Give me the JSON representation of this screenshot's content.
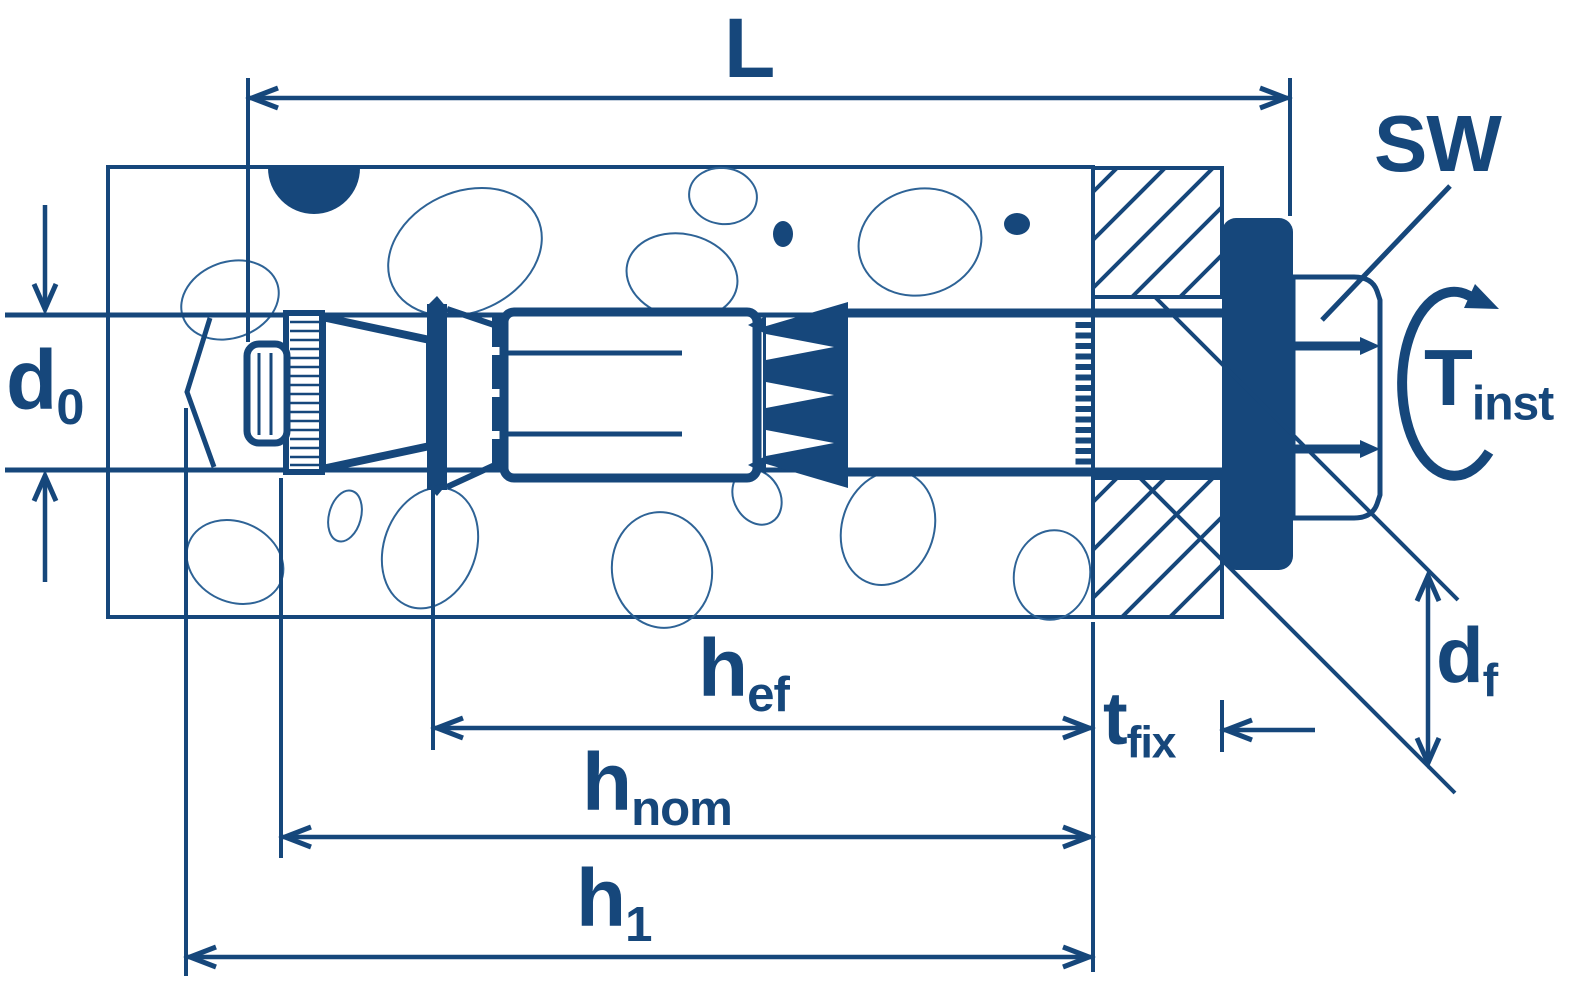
{
  "diagram": {
    "type": "anchor-installation-drawing",
    "colors": {
      "ink": "#16477B",
      "aggregate_line": "#2E6396",
      "background": "#FFFFFF"
    },
    "labels": {
      "length_overall": {
        "main": "L",
        "sub": ""
      },
      "wrench_size": {
        "main": "SW",
        "sub": ""
      },
      "install_torque": {
        "main": "T",
        "sub": "inst"
      },
      "drill_diameter": {
        "main": "d",
        "sub": "0"
      },
      "flange_diameter": {
        "main": "d",
        "sub": "f"
      },
      "effective_depth": {
        "main": "h",
        "sub": "ef"
      },
      "nominal_depth": {
        "main": "h",
        "sub": "nom"
      },
      "hole_depth": {
        "main": "h",
        "sub": "1"
      },
      "fixture_thickness": {
        "main": "t",
        "sub": "fix"
      }
    }
  }
}
